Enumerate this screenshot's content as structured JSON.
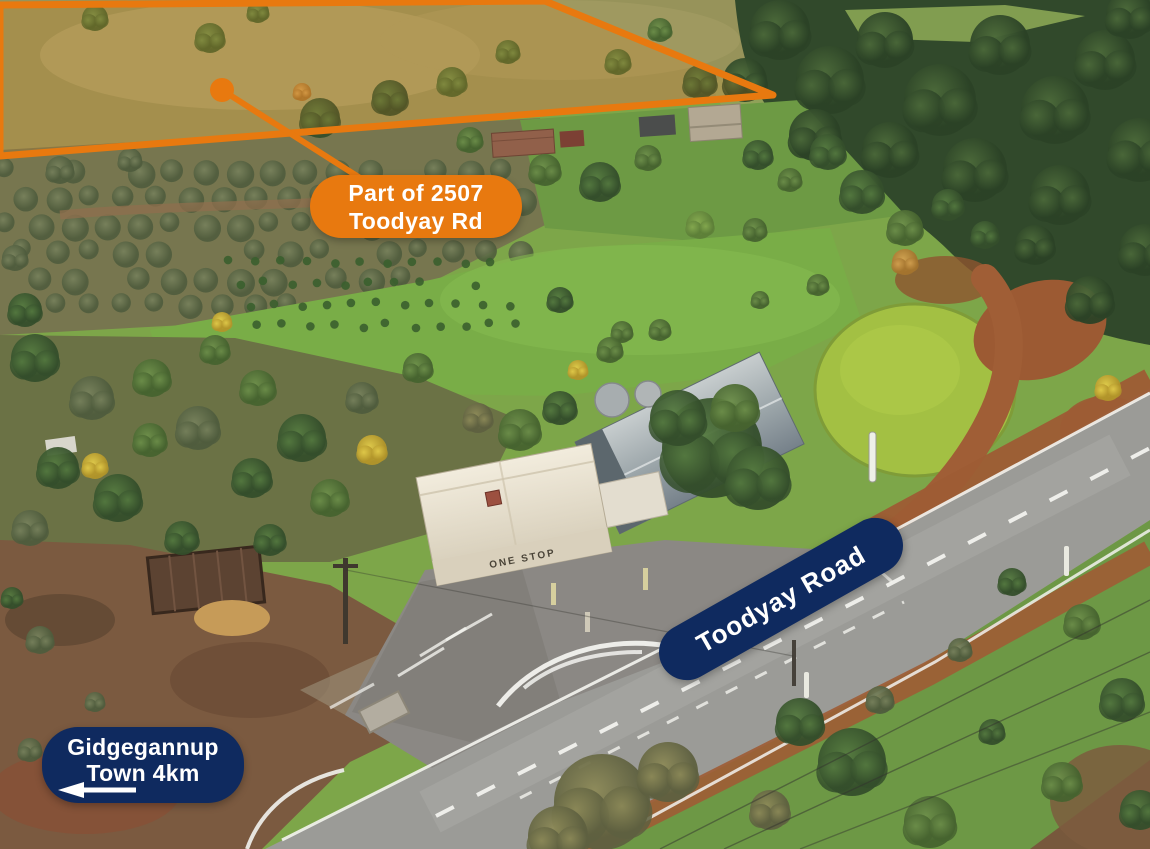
{
  "annotations": {
    "property_label": {
      "line1": "Part of 2507",
      "line2": "Toodyay Rd"
    },
    "road_label": {
      "text": "Toodyay Road"
    },
    "direction_label": {
      "line1": "Gidgegannup",
      "line2": "Town 4km",
      "arrow_direction": "left"
    },
    "colors": {
      "orange": "#E8790F",
      "navy": "#0F2A5F",
      "label_text": "#FFFFFF"
    }
  },
  "scene": {
    "building_sign": "ONE STOP"
  }
}
